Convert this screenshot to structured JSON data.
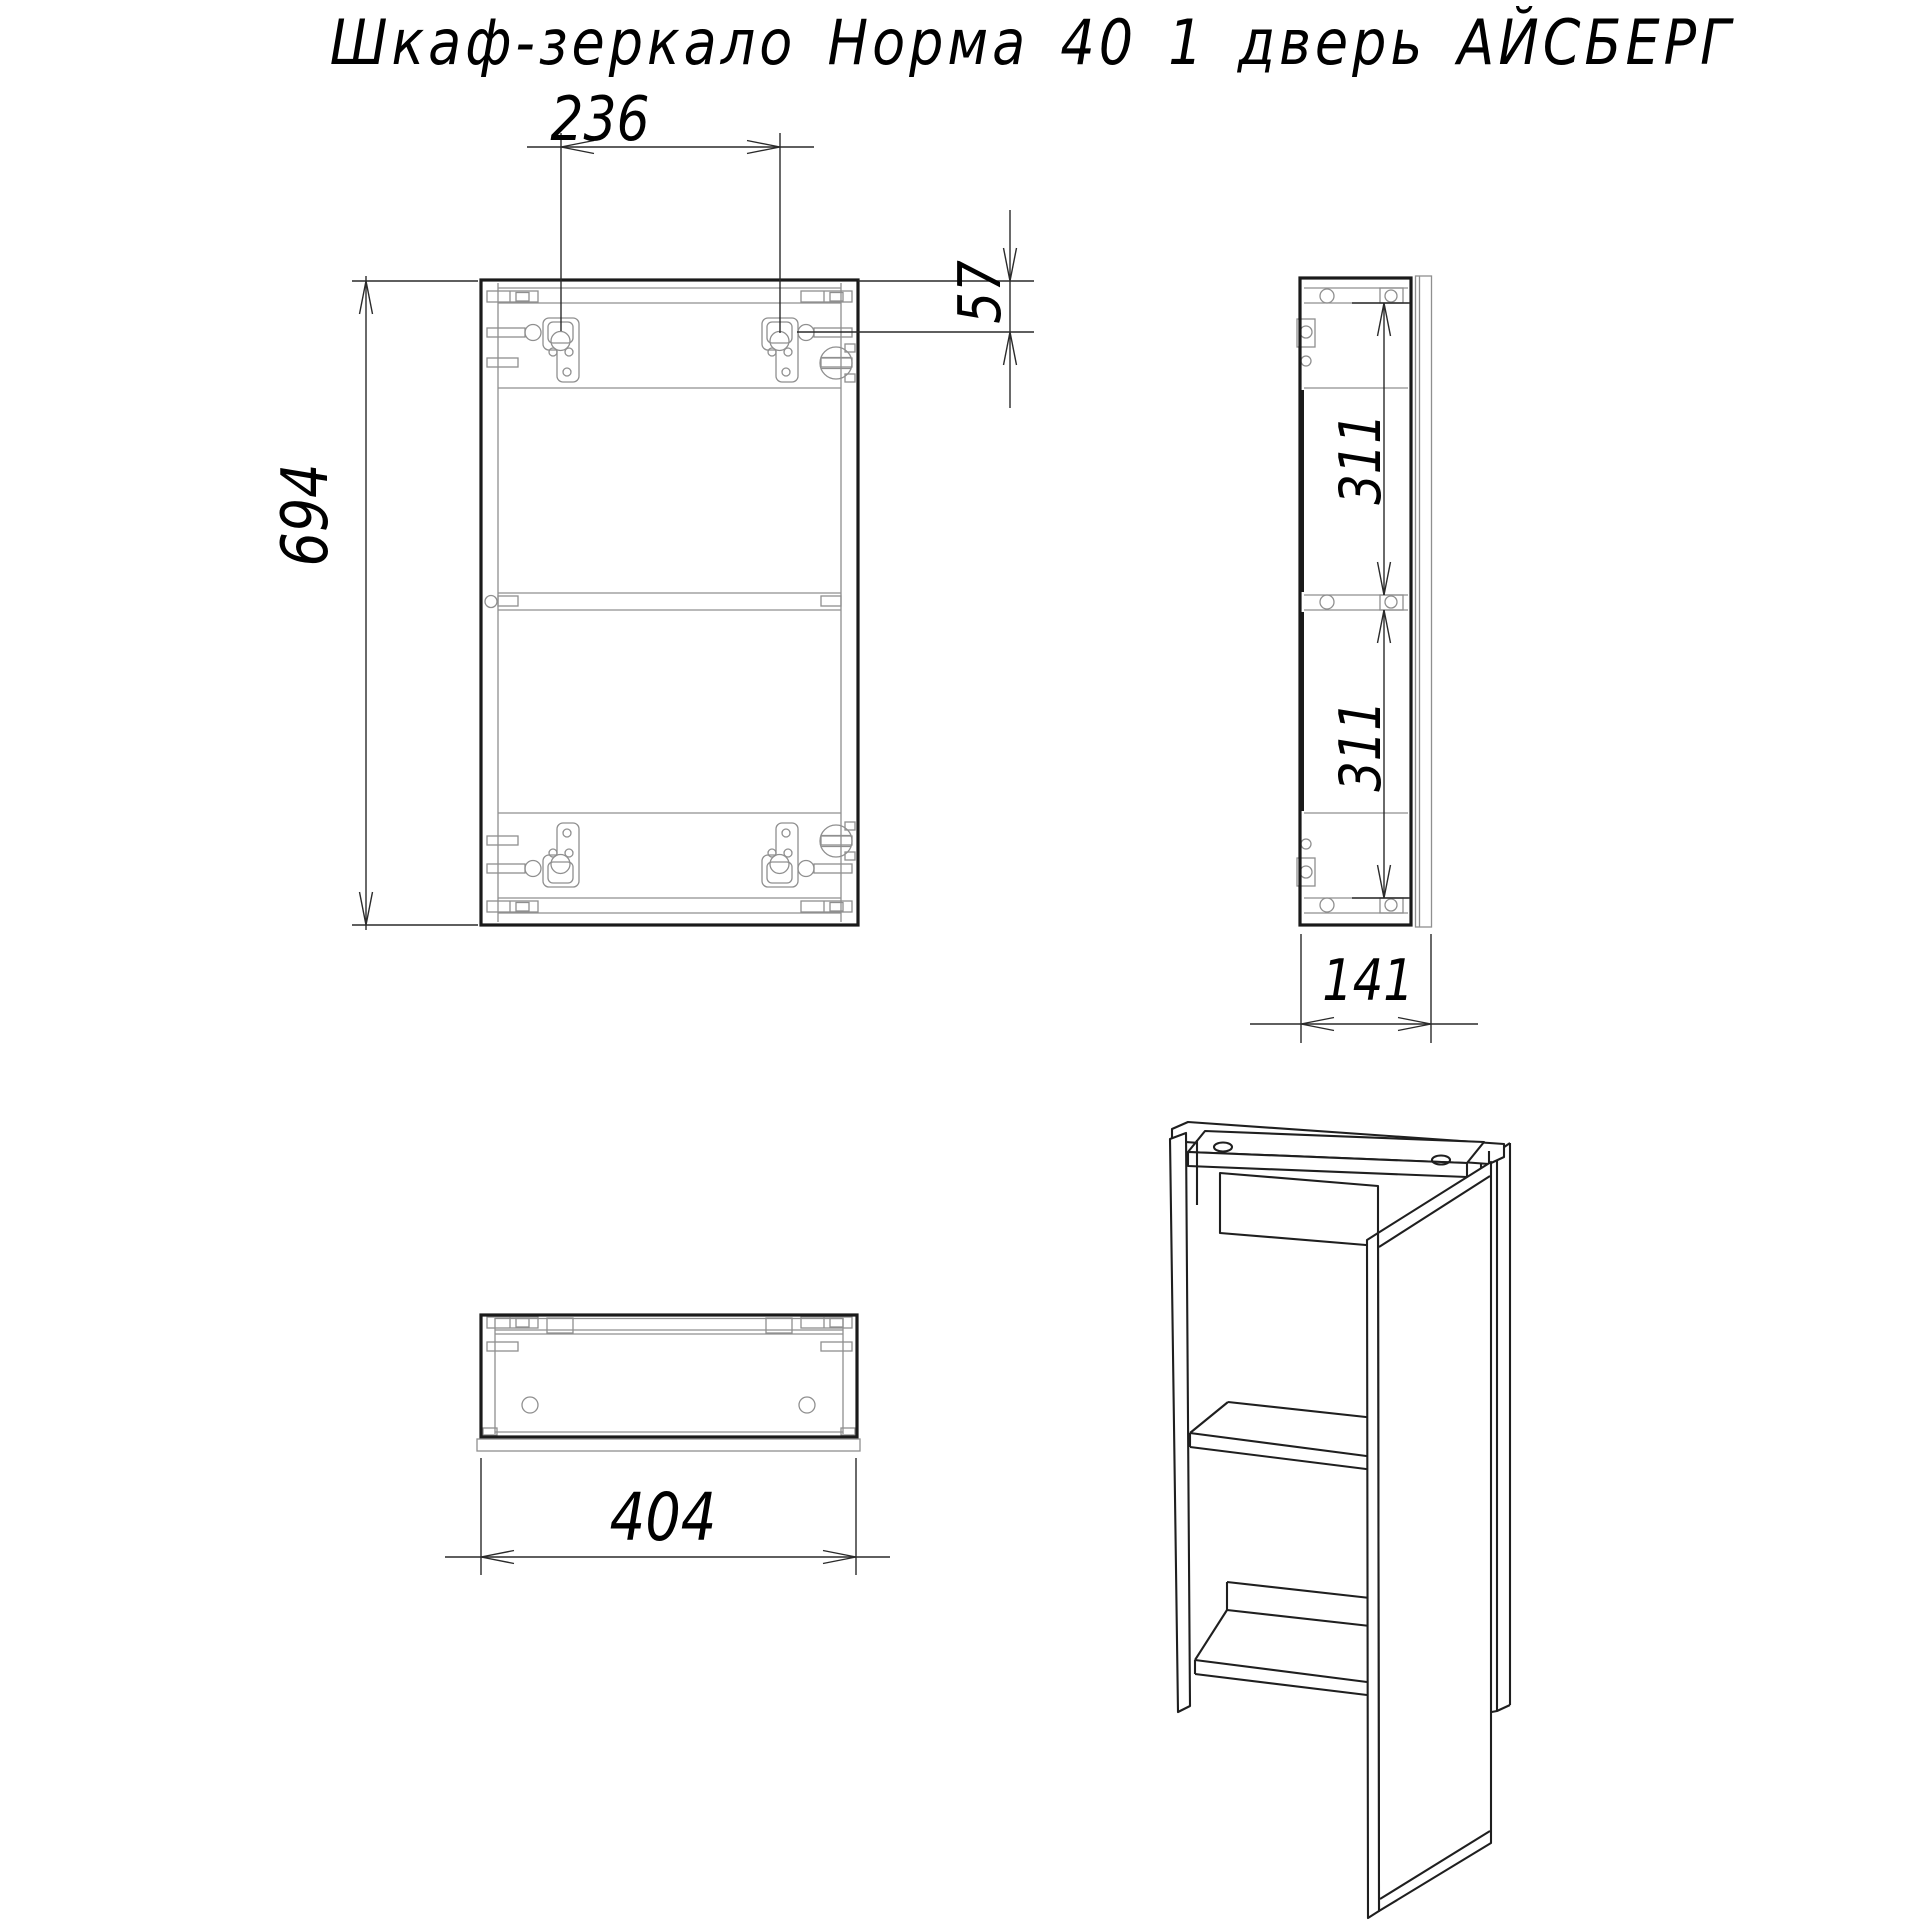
{
  "title": "Шкаф-зеркало Норма 40 1 дверь АЙСБЕРГ",
  "colors": {
    "background": "#ffffff",
    "outline": "#1a1a1a",
    "detail_line": "#8f8f8f",
    "dimension_line": "#2a2a2a",
    "text": "#000000"
  },
  "dimensions": {
    "front_hanger_spacing": "236",
    "front_hanger_top_offset": "57",
    "front_height": "694",
    "side_upper_section": "311",
    "side_lower_section": "311",
    "side_depth": "141",
    "bottom_width": "404"
  }
}
